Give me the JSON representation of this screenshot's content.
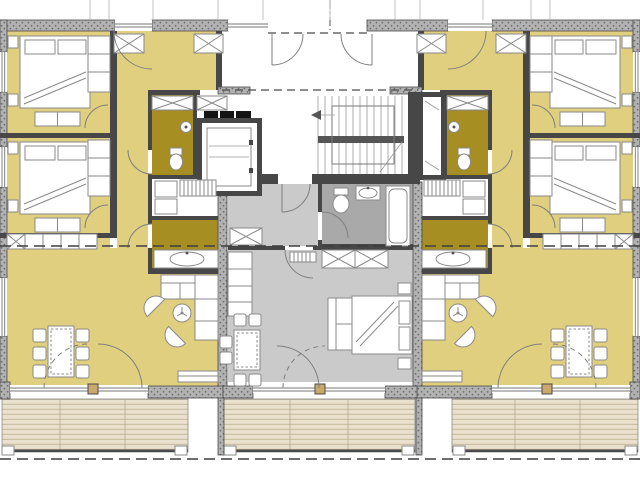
{
  "document": {
    "kind": "architectural floor plan",
    "description": "Mirrored upper-storey plan of a multi-family house: two large flats left and right, a small studio flat in the middle, central stair-and-elevator core with entrance vestibule, timber-decked balconies along the bottom",
    "visible_text_labels": []
  },
  "colors": {
    "room_yellow": "#e0cf7e",
    "room_olive": "#a68e23",
    "room_gray": "#cacaca",
    "bath_gray": "#a9a9a9",
    "wall_dark": "#474747",
    "wall_hatch_base": "#b2b2b2",
    "deck": "#e9e0cd",
    "deck_stripe": "#cbbfa4",
    "furniture_line": "#8a8a8a",
    "pier_tan": "#c9a86a",
    "white": "#ffffff"
  },
  "apartment_left": {
    "rooms": [
      "bedroom-1",
      "bedroom-2",
      "hallway",
      "shower-room-wc",
      "utility-room",
      "bathroom",
      "living-dining-room"
    ],
    "furniture": [
      "double-bed x2",
      "pillow pairs",
      "dresser x2",
      "built-in wardrobe x2",
      "x-marked closets",
      "shelf row",
      "dining-table",
      "chairs x6",
      "corner-sofa",
      "armchair x2",
      "plant-side-table",
      "tv-sideboard",
      "washer-stack",
      "radiator-manifold",
      "wc",
      "shower-head",
      "vanity-basin"
    ],
    "openings": [
      "entry-door",
      "bedroom-doors",
      "bath-doors",
      "terrace-doors",
      "windows x3"
    ],
    "terrace": "timber deck"
  },
  "apartment_right": {
    "rooms": [
      "bedroom-1",
      "bedroom-2",
      "hallway",
      "shower-room-wc",
      "utility-room",
      "bathroom",
      "living-dining-room"
    ],
    "furniture": [
      "double-bed x2",
      "pillow pairs",
      "dresser x2",
      "built-in wardrobe x2",
      "x-marked closets",
      "shelf row",
      "dining-table",
      "chairs x6",
      "corner-sofa",
      "armchair x2",
      "plant-side-table",
      "tv-sideboard",
      "washer-stack",
      "radiator-manifold",
      "wc",
      "shower-head",
      "vanity-basin"
    ],
    "openings": [
      "entry-door",
      "bedroom-doors",
      "bath-doors",
      "terrace-doors",
      "windows x3"
    ],
    "terrace": "timber deck"
  },
  "apartment_center": {
    "rooms": [
      "hallway",
      "bathroom",
      "studio-living-bedroom"
    ],
    "furniture": [
      "kitchenette-row",
      "x-marked closet x2",
      "double-bed",
      "bench-sofa",
      "nightstand x2",
      "square-table",
      "chairs x6",
      "wc",
      "wash-basin",
      "bathtub",
      "radiator"
    ],
    "openings": [
      "entry-door",
      "bath-door",
      "balcony-doors"
    ],
    "balcony": "timber deck"
  },
  "core": {
    "elements": [
      "entrance-vestibule",
      "double-vestibule-doors",
      "glazed-entrance",
      "corridor",
      "elevator-car",
      "elevator-control-marks",
      "stair-flight-up",
      "stair-landing",
      "stair-direction-arrow",
      "service-shaft"
    ],
    "stair_tread_count": 13
  },
  "site_lines": {
    "section_line_y": 246,
    "boundary_dashed_line_y": 459,
    "vestibule_overhang_dashed_y": 33,
    "corridor_dashed_y": 90
  }
}
